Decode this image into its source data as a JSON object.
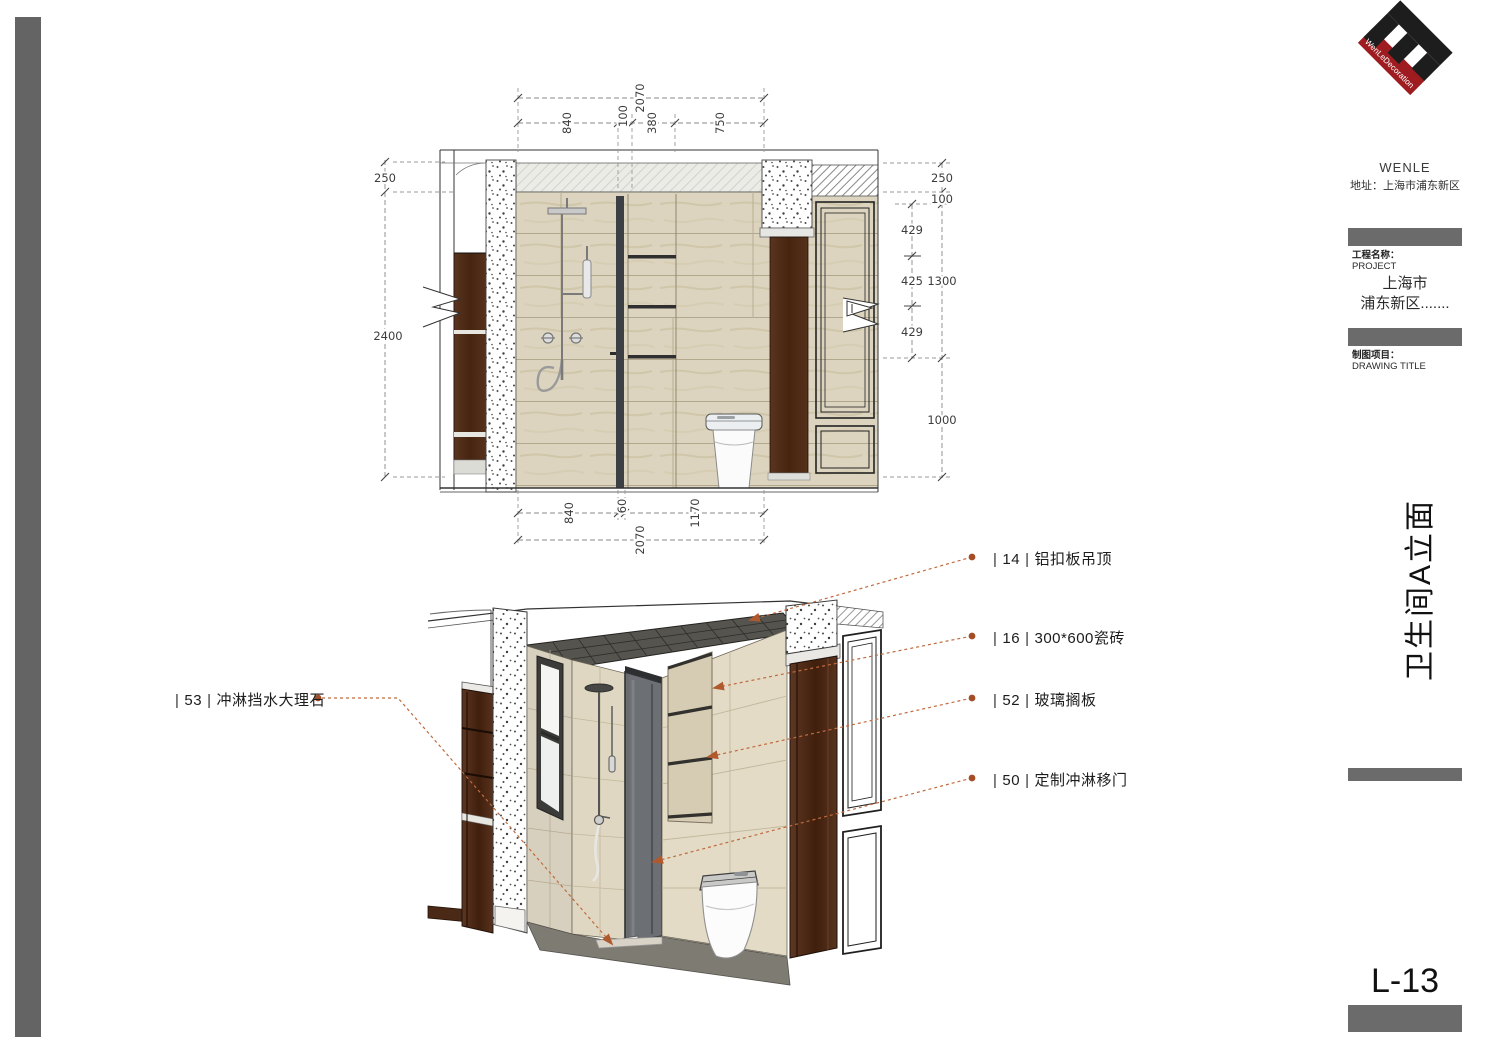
{
  "logo": {
    "ring_text": "WenLeDecoration",
    "company": "WENLE",
    "address": "地址：上海市浦东新区",
    "black": "#1d1d1d",
    "red": "#9e1c20"
  },
  "title_block": {
    "project_label": "工程名称：",
    "project_label_en": "PROJECT",
    "project_line1": "上海市",
    "project_line2": "浦东新区.......",
    "drawing_label": "制图项目：",
    "drawing_label_en": "DRAWING TITLE",
    "drawing_title_vertical": "卫生间A立面",
    "job_label": "项目编号：",
    "job_label_en": "JOB NO.",
    "job_value": "",
    "date_label": "日期：",
    "date_label_en": "DATE",
    "date_value": "2017,09,10",
    "designer_label": "设计师:",
    "designer_label_en": "DESIGNER",
    "designer_value": "PAN",
    "maparea_label": "图 幅:",
    "maparea_label_en": "MAPAREA",
    "maparea_value": "A3",
    "scale_label": "比 例",
    "scale_label_en": "SCALE",
    "scale_value": "",
    "dwg_label": "图纸编号:",
    "dwg_label_en": "DWG NO.",
    "dwg_value": "",
    "sheet_number": "L-13"
  },
  "callouts": {
    "sep": "|",
    "accent": "#b55a32",
    "right": [
      {
        "num": "14",
        "text": "铝扣板吊顶"
      },
      {
        "num": "16",
        "text": "300*600瓷砖"
      },
      {
        "num": "52",
        "text": "玻璃搁板"
      },
      {
        "num": "50",
        "text": "定制冲淋移门"
      }
    ],
    "left": [
      {
        "num": "53",
        "text": "冲淋挡水大理石"
      }
    ]
  },
  "dimensions": {
    "top": {
      "overall": "2070",
      "segments": [
        "840",
        "100",
        "380",
        "750"
      ]
    },
    "bottom": {
      "overall": "2070",
      "segments": [
        "840",
        "60",
        "1170"
      ]
    },
    "left": {
      "segments": [
        "250",
        "2400"
      ]
    },
    "right": {
      "outer": [
        "250",
        "100",
        "1300",
        "1000"
      ],
      "inner": [
        "429",
        "425",
        "429"
      ]
    }
  }
}
